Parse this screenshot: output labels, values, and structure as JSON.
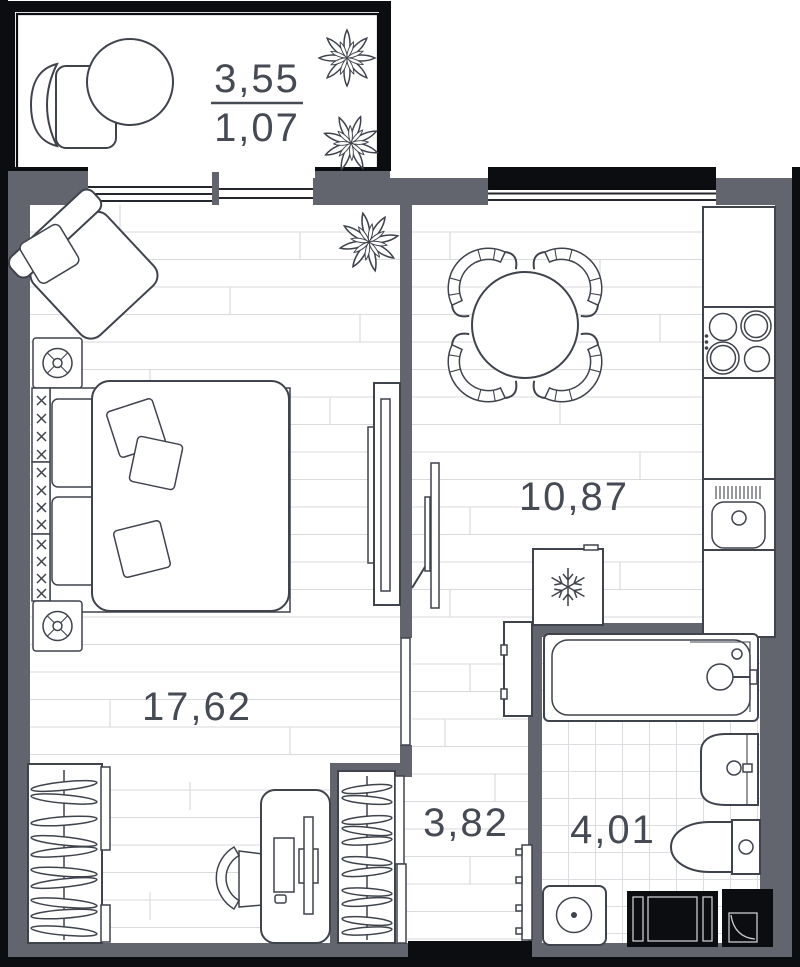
{
  "plan": {
    "balcony": {
      "area_total": "3,55",
      "area_reduced": "1,07"
    },
    "bedroom": {
      "area": "17,62"
    },
    "kitchen": {
      "area": "10,87"
    },
    "hallway": {
      "area": "3,82"
    },
    "bathroom": {
      "area": "4,01"
    }
  },
  "colors": {
    "wall": "#62656e",
    "outline": "#3f434c",
    "frame_black": "#0b0d11",
    "floor_line": "#d9dadc",
    "tile_line": "#dcdde0",
    "label_text": "#454a54",
    "background": "#ffffff"
  }
}
